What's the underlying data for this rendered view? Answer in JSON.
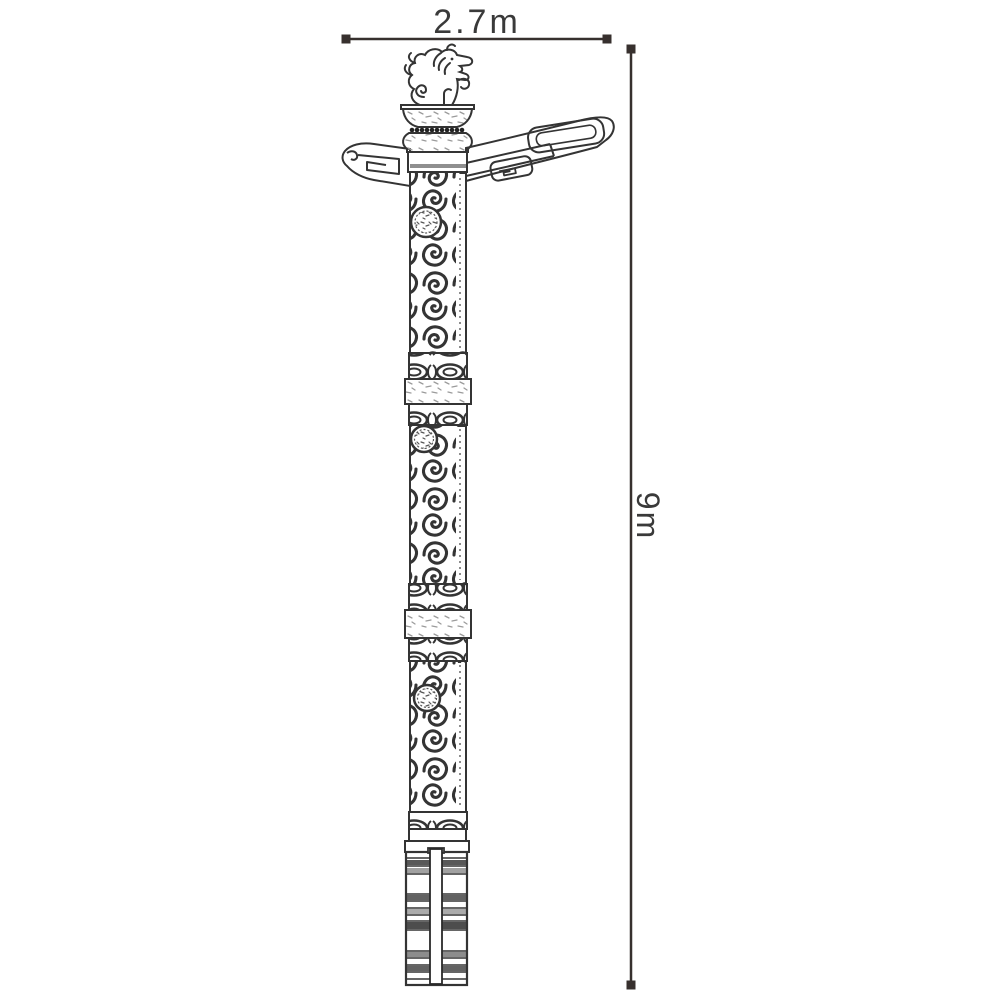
{
  "page": {
    "background": "#ffffff"
  },
  "drawing": {
    "subject": "ornamental-dragon-totem-column-dimension-drawing",
    "stroke_color": "#343434",
    "dimension_color": "#37302e",
    "text_color": "#3a3a3a",
    "width_dimension": {
      "label": "2.7m"
    },
    "height_dimension": {
      "label": "9m"
    }
  }
}
